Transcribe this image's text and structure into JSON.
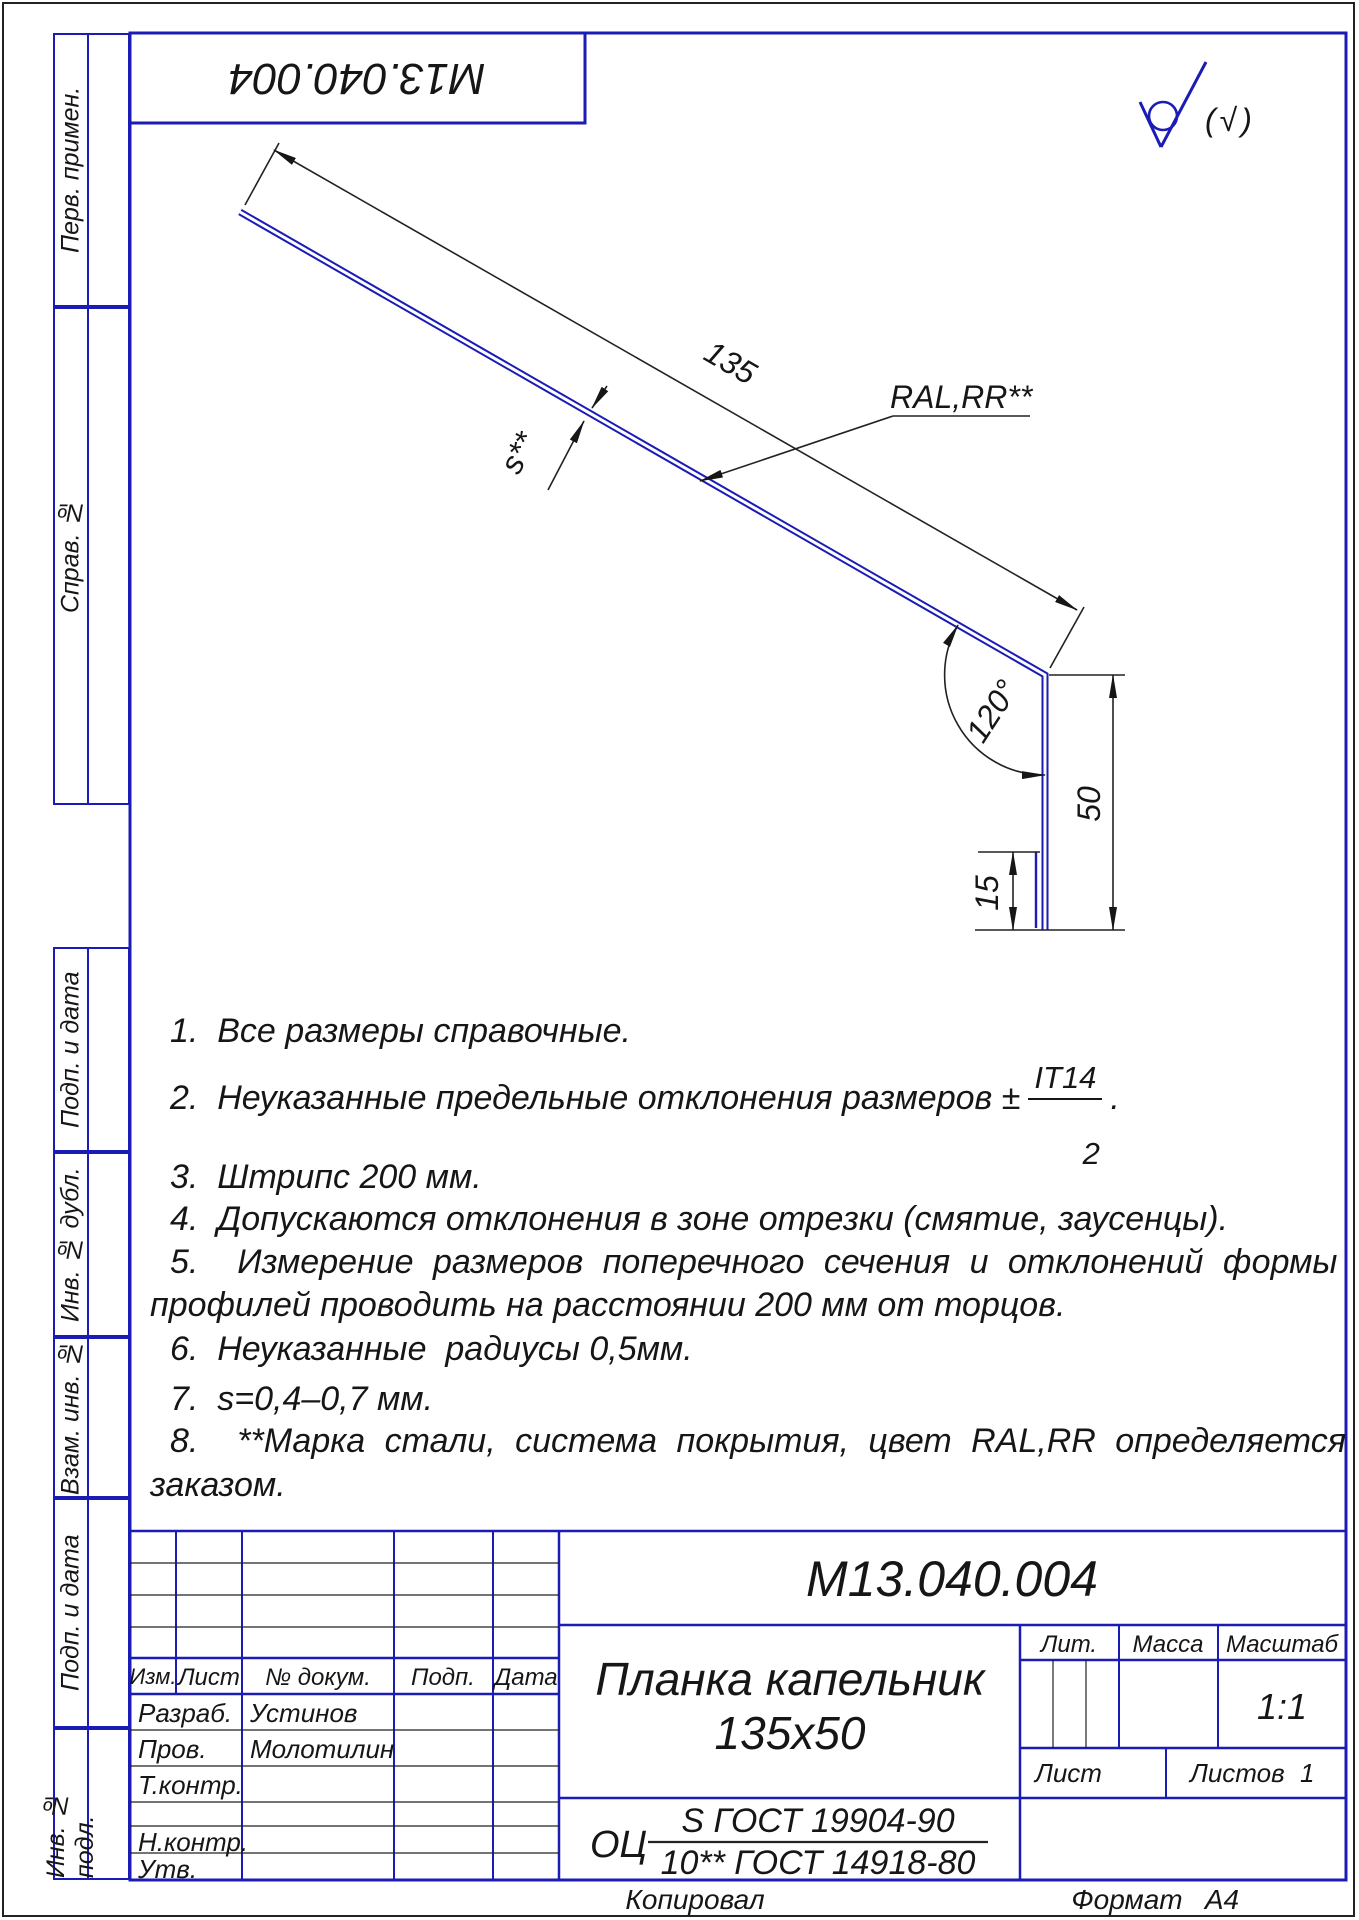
{
  "colors": {
    "accent-blue": "#1b1bb5",
    "ink": "#161616"
  },
  "page": {
    "doc_number_reversed": "М13.040.004",
    "roughness_note": "(√)",
    "kopiroval": "Копировал",
    "format_label": "Формат",
    "format_value": "А4"
  },
  "margin_labels": {
    "perv_primen": "Перв. примен.",
    "sprav_no": "Справ. №",
    "podp_data_1": "Подп. и дата",
    "inv_no_dubl": "Инв. № дубл.",
    "vzam_inv_no": "Взам. инв. №",
    "podp_data_2": "Подп. и дата",
    "inv_no_podl": "Инв. № подл."
  },
  "drawing": {
    "dim_length": "135",
    "dim_thickness": "s**",
    "dim_angle": "120°",
    "dim_height": "50",
    "dim_hem": "15",
    "coating_label": "RAL,RR**"
  },
  "notes": {
    "n1": "1.  Все размеры справочные.",
    "n2_prefix": "2.  Неуказанные предельные отклонения размеров ±",
    "n2_frac_top": "IT14",
    "n2_frac_bottom": "2",
    "n2_suffix": ".",
    "n3": "3.  Штрипс 200 мм.",
    "n4": "4.  Допускаются отклонения в зоне отрезки (смятие, заусенцы).",
    "n5_line1": "5.  Измерение размеров поперечного сечения и отклонений формы",
    "n5_line2": "профилей проводить на расстоянии 200 мм от торцов.",
    "n6": "6.  Неуказанные  радиусы 0,5мм.",
    "n7": "7.  s=0,4–0,7 мм.",
    "n8_line1": "8.  **Марка стали, система покрытия, цвет RAL,RR определяется",
    "n8_line2": "заказом."
  },
  "title_block": {
    "doc_number": "М13.040.004",
    "part_name_line1": "Планка капельник",
    "part_name_line2": "135х50",
    "header": {
      "izm": "Изм.",
      "list": "Лист",
      "doc_no": "№ докум.",
      "podp": "Подп.",
      "data": "Дата"
    },
    "roles": {
      "razrab_label": "Разраб.",
      "razrab_name": "Устинов",
      "prov_label": "Пров.",
      "prov_name": "Молотилин",
      "tkontr_label": "Т.контр.",
      "nkontr_label": "Н.контр.",
      "utv_label": "Утв."
    },
    "lit_label": "Лит.",
    "massa_label": "Масса",
    "masshtab_label": "Масштаб",
    "scale_value": "1:1",
    "list_label": "Лист",
    "listov_label": "Листов",
    "listov_value": "1",
    "material_prefix": "ОЦ",
    "material_top": "S ГОСТ 19904-90",
    "material_bottom": "10** ГОСТ 14918-80"
  }
}
